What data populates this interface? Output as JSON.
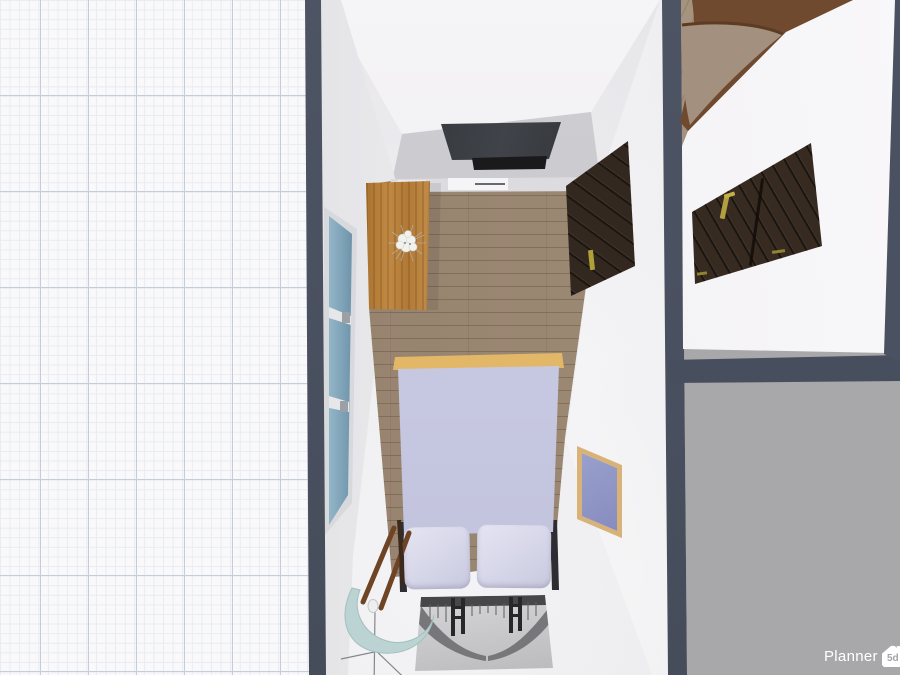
{
  "meta": {
    "app_name": "Planner 5d",
    "view": "3d-top-down-room-view"
  },
  "watermark": {
    "brand": "Planner",
    "logo_text": "5d"
  },
  "palette": {
    "wall_cut_slate": "#495061",
    "outside_gray": "#a8a8aa",
    "grid_bg": "#f9f9fb",
    "grid_minor_line": "#e9ebf0",
    "grid_major_line": "#c6cdda",
    "interior_wall": "#f3f2f4",
    "north_wall_lower": "#c9c8cd",
    "wood_floor": "#97846f",
    "sideboard_wood": "#b87d3c",
    "bed_blanket": "#c6c7e0",
    "bed_pillow": "#d9d9ea",
    "headboard_wood": "#e9bd6d",
    "window_glass": "#84a8bd",
    "wardrobe_dark_wood": "#33281f",
    "panel_door_wood": "#372b21",
    "handle_gold": "#b1a040",
    "frame_border": "#d9b277",
    "frame_canvas": "#8d93c3",
    "chair_seat": "#bcd3d3",
    "rug_base": "#cfcfd2",
    "curved_wall_walnut": "#6f4a2e",
    "tv_screen": "#202124"
  },
  "scene": {
    "bedroom_objects": [
      "window",
      "sideboard with flower decor",
      "wall-mounted tv",
      "tv stand",
      "dark wardrobe door",
      "double bed with two pillows",
      "picture frame",
      "chair",
      "bridge-print rug"
    ],
    "right_room_objects": [
      "wood floor",
      "curved walnut wall",
      "dark panel door with gold handle"
    ]
  }
}
